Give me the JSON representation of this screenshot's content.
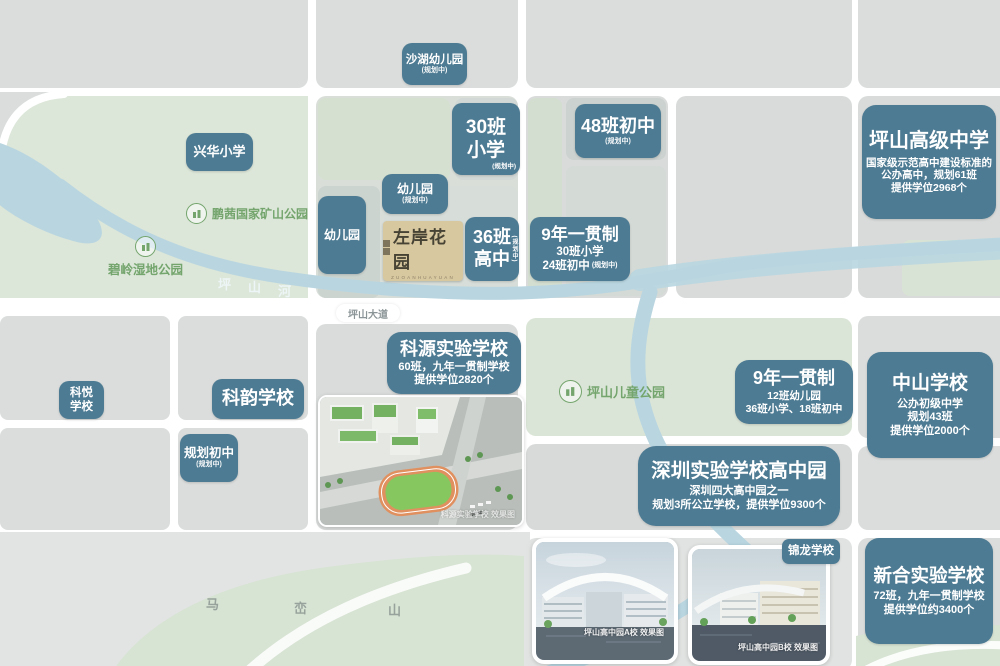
{
  "colors": {
    "badge": "#4d7b93",
    "badge-text": "#ffffff",
    "logo-bg": "#d8c8a0",
    "logo-text": "#474334",
    "park-text": "#74a56d",
    "river": "#b9d6e0",
    "road-label": "#8b9496",
    "mountain-text": "#97a29c",
    "river-label": "#eef5f6"
  },
  "badges": {
    "shahu": {
      "title": "沙湖幼儿园",
      "sub": "(规划中)"
    },
    "xinghua": {
      "title": "兴华小学"
    },
    "class30": {
      "line1": "30班",
      "line2": "小学",
      "sub": "(规划中)"
    },
    "class48": {
      "title": "48班初中",
      "sub": "(规划中)"
    },
    "pingshan_senior": {
      "title": "坪山高级中学",
      "desc1": "国家级示范高中建设标准的",
      "desc2": "公办高中，规划61班",
      "desc3": "提供学位2968个"
    },
    "kg_planned": {
      "title": "幼儿园",
      "sub": "(规划中)"
    },
    "kg": {
      "title": "幼儿园"
    },
    "class36": {
      "line1": "36班",
      "line2": "高中",
      "sub": "(规划中)"
    },
    "nine_year_a": {
      "title": "9年一贯制",
      "line2": "30班小学",
      "line3": "24班初中",
      "sub": "(规划中)"
    },
    "keyuan": {
      "title": "科源实验学校",
      "desc1": "60班，九年一贯制学校",
      "desc2": "提供学位2820个"
    },
    "keyue": {
      "line1": "科悦",
      "line2": "学校"
    },
    "keyun": {
      "title": "科韵学校"
    },
    "planned_junior": {
      "title": "规划初中",
      "sub": "(规划中)"
    },
    "nine_year_b": {
      "title": "9年一贯制",
      "desc1": "12班幼儿园",
      "desc2": "36班小学、18班初中"
    },
    "zhongshan": {
      "title": "中山学校",
      "desc1": "公办初级中学",
      "desc2": "规划43班",
      "desc3": "提供学位2000个"
    },
    "shenzhen_exp": {
      "title": "深圳实验学校高中园",
      "desc1": "深圳四大高中园之一",
      "desc2": "规划3所公立学校，提供学位9300个"
    },
    "jinlong": {
      "title": "锦龙学校"
    },
    "xinhe": {
      "title": "新合实验学校",
      "desc1": "72班，九年一贯制学校",
      "desc2": "提供学位约3400个"
    }
  },
  "parks": {
    "pengqian": "鹏茜国家矿山公园",
    "biling": "碧岭湿地公园",
    "children": "坪山儿童公园"
  },
  "geo": {
    "river": [
      "坪",
      "山",
      "河"
    ],
    "mountain": [
      "马",
      "峦",
      "山"
    ],
    "avenue": "坪山大道"
  },
  "logo": {
    "name": "左岸花园",
    "pinyin": "ZUOANHUAYUAN"
  },
  "photos": {
    "keyuan": {
      "caption": "科源实验学校 效果图"
    },
    "campus_a": {
      "caption": "坪山高中园A校 效果图"
    },
    "campus_b": {
      "caption": "坪山高中园B校 效果图"
    }
  }
}
